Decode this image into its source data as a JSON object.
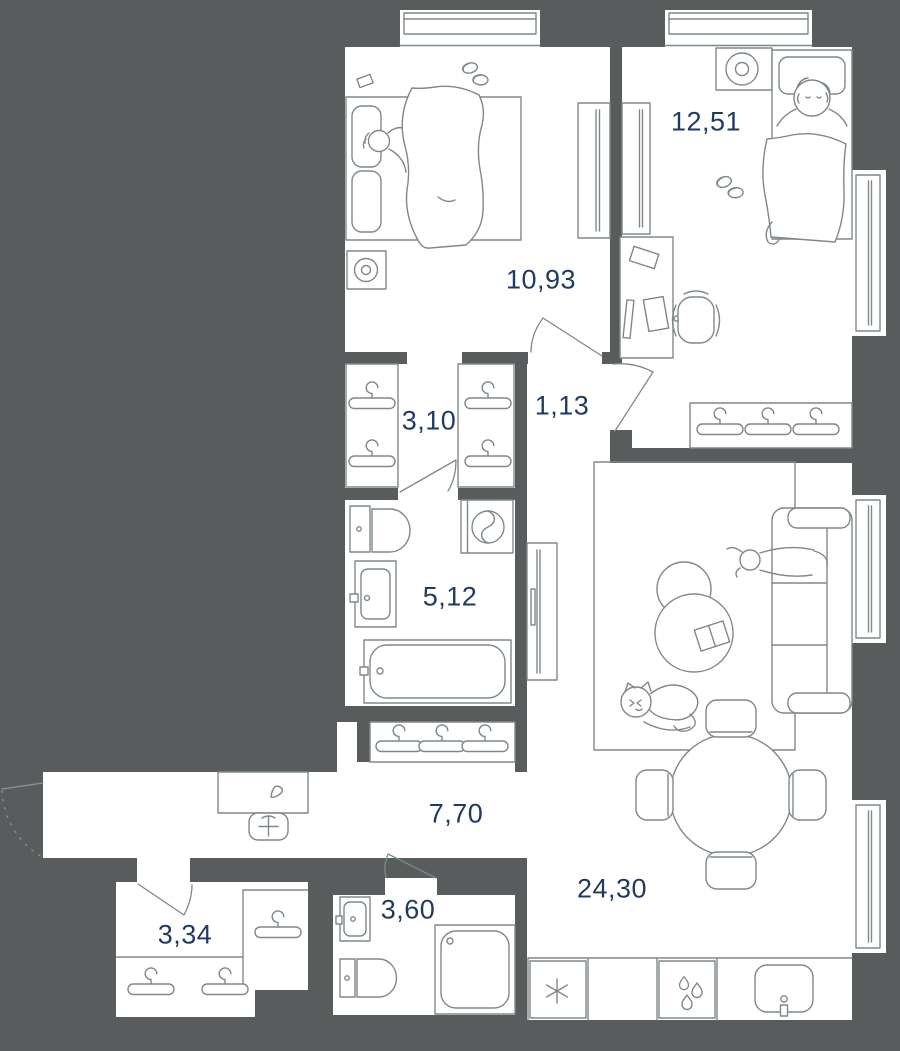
{
  "title": "apartment-floor-plan",
  "colors": {
    "background": "#585c5c",
    "floor": "#ffffff",
    "furniture_line": "#7f8888",
    "label_text": "#1f3a5f"
  },
  "rooms": [
    {
      "id": "bedroom-2",
      "area": "12,51"
    },
    {
      "id": "bedroom-1",
      "area": "10,93"
    },
    {
      "id": "wardrobe",
      "area": "3,10"
    },
    {
      "id": "corridor",
      "area": "1,13"
    },
    {
      "id": "bathroom",
      "area": "5,12"
    },
    {
      "id": "hallway",
      "area": "7,70"
    },
    {
      "id": "living-kitchen",
      "area": "24,30"
    },
    {
      "id": "storage",
      "area": "3,34"
    },
    {
      "id": "wc",
      "area": "3,60"
    }
  ]
}
